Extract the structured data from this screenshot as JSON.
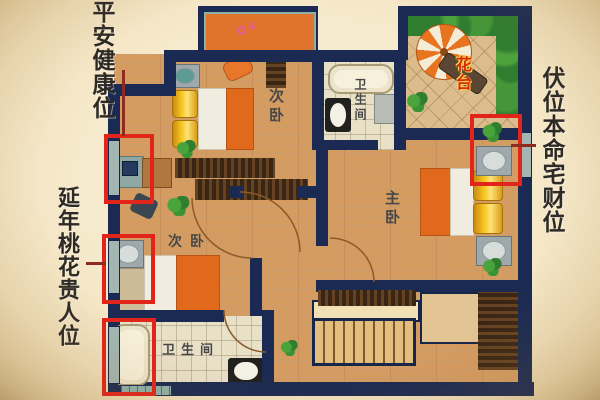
{
  "annotations": {
    "left_top_label": "平安健康位",
    "left_mid_label": "延年桃花贵人位",
    "right_label": "伏位本命宅财位"
  },
  "floorplan": {
    "bedroom1_label": "次卧",
    "bedroom2_label": "次卧",
    "master_label": "主卧",
    "bath_top_label": "卫生间",
    "bath_bottom_label": "卫生间",
    "terrace_label": "花台"
  },
  "colors": {
    "highlight_red": "#e1251b",
    "connector_red": "#8e2b20",
    "wall_navy": "#1b2a52",
    "wood_floor": "#d59c62",
    "dark_wood": "#3a2615",
    "accent_orange": "#e0691c",
    "pillow_yellow": "#f7c51e",
    "terrace_text_red": "#d42b10",
    "background_beige": "#f3e5c6",
    "teal_window": "#8fb2aa"
  }
}
